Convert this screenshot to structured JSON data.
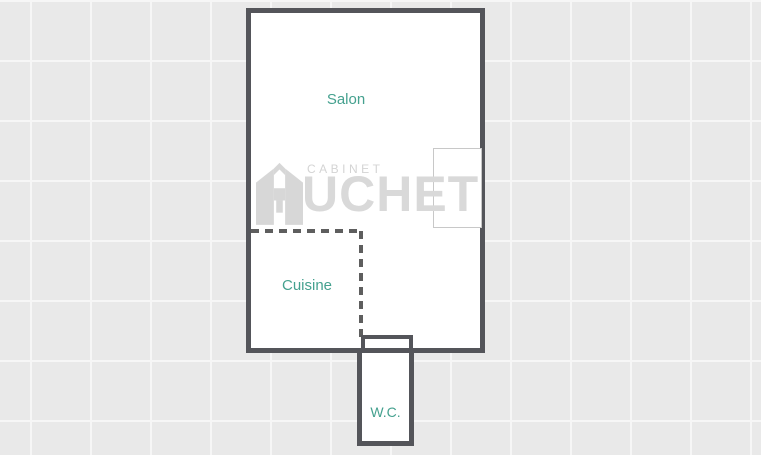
{
  "canvas": {
    "background_color": "#e9e9e9",
    "grid_color": "#f6f6f6",
    "grid_size_px": 60
  },
  "floorplan": {
    "wall_color": "#54555a",
    "partition_color": "#5e5e5e",
    "room_fill": "#ffffff",
    "label_color": "#45a18f",
    "labels": {
      "salon": "Salon",
      "cuisine": "Cuisine",
      "wc": "W.C."
    }
  },
  "watermark": {
    "color": "#d7d7d7",
    "line1": "CABINET",
    "line2": "UCHET",
    "logo_icon": "house-letter-h-icon"
  }
}
